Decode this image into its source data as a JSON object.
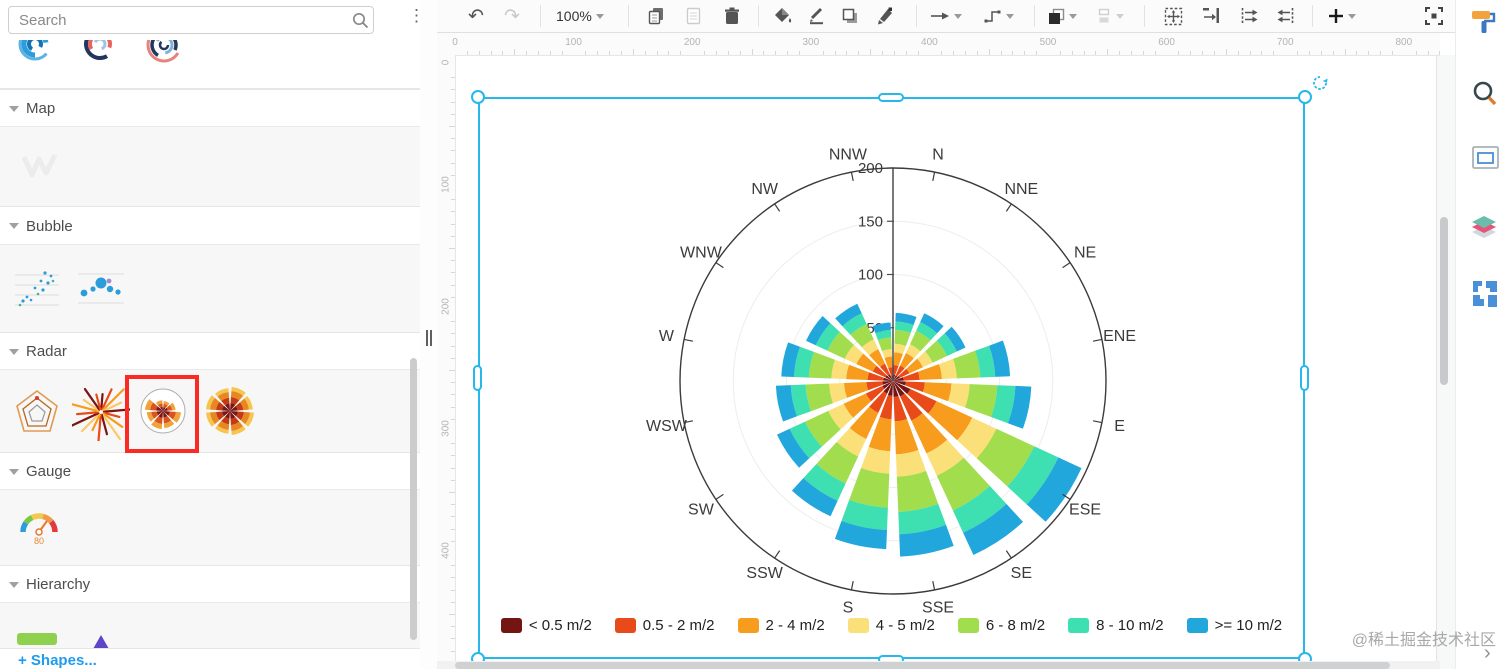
{
  "sidebar": {
    "search": {
      "placeholder": "Search"
    },
    "menu_icon": "kebab-menu",
    "sections": [
      {
        "label": "Map"
      },
      {
        "label": "Bubble"
      },
      {
        "label": "Radar"
      },
      {
        "label": "Gauge"
      },
      {
        "label": "Hierarchy"
      }
    ],
    "radar_items": [
      "radar-pentagon",
      "radial-burst",
      "wind-rose-circled",
      "wind-rose-full"
    ],
    "selected_item": "wind-rose-circled",
    "gauge_value": "80",
    "shapes_link": "+ Shapes..."
  },
  "toolbar": {
    "zoom_label": "100%",
    "buttons": [
      "undo",
      "redo",
      "zoom-select",
      "copy",
      "paste",
      "delete",
      "fill-color",
      "line-color",
      "shadow",
      "format-painter",
      "connection-arrow",
      "connection-style",
      "to-front",
      "align",
      "select-all",
      "fit-page",
      "distribute-right",
      "distribute-left",
      "insert-plus",
      "fullscreen"
    ]
  },
  "rulers": {
    "horizontal_labels": [
      "0",
      "100",
      "200",
      "300",
      "400",
      "500",
      "600",
      "700",
      "800"
    ],
    "vertical_labels": [
      "0",
      "100",
      "200",
      "300",
      "400"
    ]
  },
  "canvas": {
    "watermark": "@稀土掘金技术社区",
    "expand_chevron": "›"
  },
  "right_panel": {
    "icons": [
      "format-paint-roller",
      "search",
      "outline",
      "layers",
      "shapes"
    ]
  },
  "chart_data": {
    "type": "bar",
    "subtype": "polar-stacked-wind-rose",
    "categories": [
      "N",
      "NNE",
      "NE",
      "ENE",
      "E",
      "ESE",
      "SE",
      "SSE",
      "S",
      "SSW",
      "SW",
      "WSW",
      "W",
      "WNW",
      "NW",
      "NNW"
    ],
    "series": [
      {
        "name": "< 0.5 m/2",
        "color": "#731512",
        "values": [
          6,
          6,
          7,
          10,
          12,
          18,
          16,
          15,
          14,
          13,
          11,
          10,
          9,
          8,
          7,
          5
        ]
      },
      {
        "name": "0.5 - 2 m/2",
        "color": "#E84A1A",
        "values": [
          9,
          10,
          10,
          15,
          18,
          27,
          25,
          23,
          22,
          20,
          17,
          15,
          15,
          13,
          11,
          8
        ]
      },
      {
        "name": "2 - 4 m/2",
        "color": "#F79C1D",
        "values": [
          12,
          13,
          14,
          21,
          25,
          37,
          34,
          31,
          30,
          27,
          23,
          21,
          20,
          17,
          15,
          10
        ]
      },
      {
        "name": "4 - 5 m/2",
        "color": "#FBE07A",
        "values": [
          8,
          9,
          10,
          14,
          17,
          25,
          23,
          21,
          21,
          18,
          16,
          14,
          14,
          12,
          10,
          7
        ]
      },
      {
        "name": "6 - 8 m/2",
        "color": "#A2DD4E",
        "values": [
          13,
          14,
          15,
          22,
          26,
          39,
          36,
          33,
          32,
          28,
          24,
          22,
          21,
          18,
          16,
          11
        ]
      },
      {
        "name": "8 - 10 m/2",
        "color": "#3EDFB0",
        "values": [
          8,
          9,
          10,
          14,
          17,
          25,
          23,
          21,
          21,
          18,
          16,
          14,
          14,
          12,
          11,
          7
        ]
      },
      {
        "name": ">= 10 m/2",
        "color": "#22A7DD",
        "values": [
          8,
          9,
          9,
          14,
          15,
          24,
          23,
          21,
          18,
          16,
          13,
          14,
          12,
          10,
          10,
          7
        ]
      }
    ],
    "radial_ticks": [
      50,
      100,
      150,
      200
    ],
    "rlim": [
      0,
      200
    ],
    "grid": true,
    "legend_position": "bottom"
  }
}
